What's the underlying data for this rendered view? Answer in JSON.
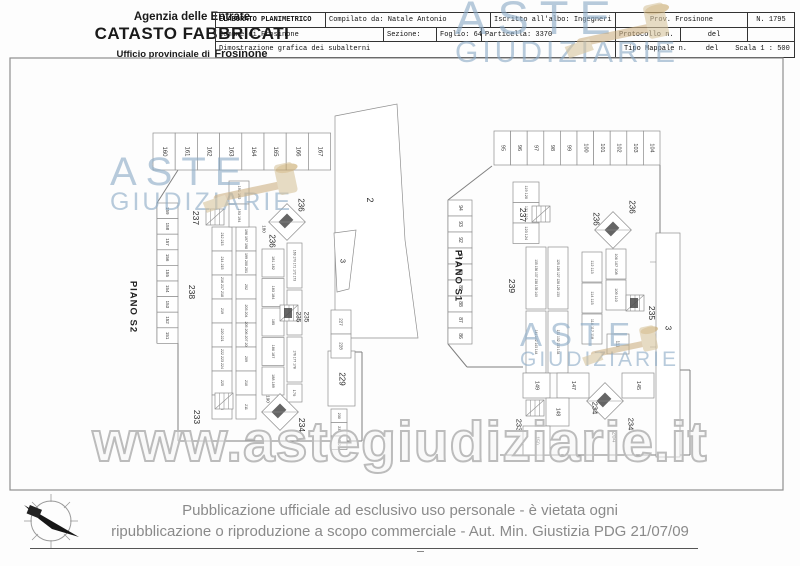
{
  "header": {
    "agency": "Agenzia delle Entrate",
    "registry": "CATASTO FABBRICATI",
    "office_prefix": "Ufficio provinciale di",
    "office_city": "Frosinone",
    "table": {
      "title": "ELABORATO PLANIMETRICO",
      "compiled_by": "Compilato da: Natale Antonio",
      "registered": "Iscritto all'albo: Ingegneri",
      "province": "Prov. Frosinone",
      "number": "N. 1795",
      "comune": "Comune di Frosinone",
      "sezione": "Sezione:",
      "foglio": "Foglio: 64",
      "particella": "Particella: 3370",
      "protocollo": "Protocollo n.",
      "del1": "del",
      "description": "Dimostrazione grafica dei subalterni",
      "tipo_mappale": "Tipo Mappale n.",
      "del2": "del",
      "scala": "Scala 1 : 500"
    }
  },
  "watermark": {
    "aste": "ASTE",
    "giudiziarie": "GIUDIZIARIE",
    "url": "www.astegiudiziarie.it",
    "blue": "#8dabc7",
    "tan": "#d8c59e"
  },
  "plans": {
    "s2": {
      "name": "PIANO S2",
      "top_row": [
        "160",
        "161",
        "162",
        "163",
        "164",
        "165",
        "166",
        "167"
      ],
      "left_col": [
        "159",
        "158",
        "157",
        "156",
        "155",
        "154",
        "153",
        "152",
        "151"
      ],
      "inner_col1": [
        "212 213",
        "214 215",
        "216 217 218",
        "219",
        "220 221",
        "222 223 224",
        "225",
        "226"
      ],
      "inner_col2": [
        "196 197 198",
        "199 200 201",
        "202",
        "203 204",
        "205 206 207 208",
        "209",
        "210",
        "211"
      ],
      "pairs_top": [
        "191 192",
        "193 194"
      ],
      "mid_col": [
        "181 182",
        "183 184",
        "185",
        "186 187",
        "188 189"
      ],
      "multi_col": [
        "169 170 171 172 173",
        "174 175",
        "176 177 178"
      ],
      "cell_179": "179",
      "col_227": [
        "227",
        "228"
      ],
      "label_229": "229",
      "col_230": [
        "230",
        "231",
        "232"
      ],
      "labels": {
        "a2": "2",
        "a3": "3",
        "l237": "237",
        "l238": "238",
        "l233": "233",
        "l234": "234",
        "l235a": "235",
        "l235b": "235",
        "l236a": "236",
        "l236b": "236",
        "l190": "190",
        "l180": "180"
      }
    },
    "s1": {
      "name": "PIANO S1",
      "top_row": [
        "95",
        "96",
        "97",
        "98",
        "99",
        "100",
        "101",
        "102",
        "103",
        "104"
      ],
      "left_col": [
        "94",
        "93",
        "92",
        "91",
        "90",
        "89",
        "88",
        "87",
        "86"
      ],
      "cluster_119": [
        "119 120",
        "121 122",
        "123 124"
      ],
      "tall_col1": [
        "135 136 137 138 139 140",
        "141 142 143 144"
      ],
      "tall_col2": [
        "125 126 127 128 129 130",
        "131 132 133 134"
      ],
      "cluster_112": [
        "112 113",
        "114 115",
        "116 117 118"
      ],
      "cluster_106": [
        "106 107 108",
        "109 110"
      ],
      "cell_111": "111",
      "stall_149": "149",
      "stall_147": "147",
      "stall_145": "145",
      "stall_148": "148",
      "stall_150": "150",
      "labels": {
        "l239": "239",
        "l237": "237",
        "l236a": "236",
        "l236b": "236",
        "l235": "235",
        "l233": "233",
        "l234a": "234",
        "l234b": "234",
        "l264": "264",
        "a3": "3"
      }
    }
  },
  "footer": {
    "line1": "Pubblicazione ufficiale ad esclusivo uso personale - è vietata ogni",
    "line2": "ripubblicazione o riproduzione a scopo commerciale - Aut. Min. Giustizia PDG 21/07/09"
  }
}
